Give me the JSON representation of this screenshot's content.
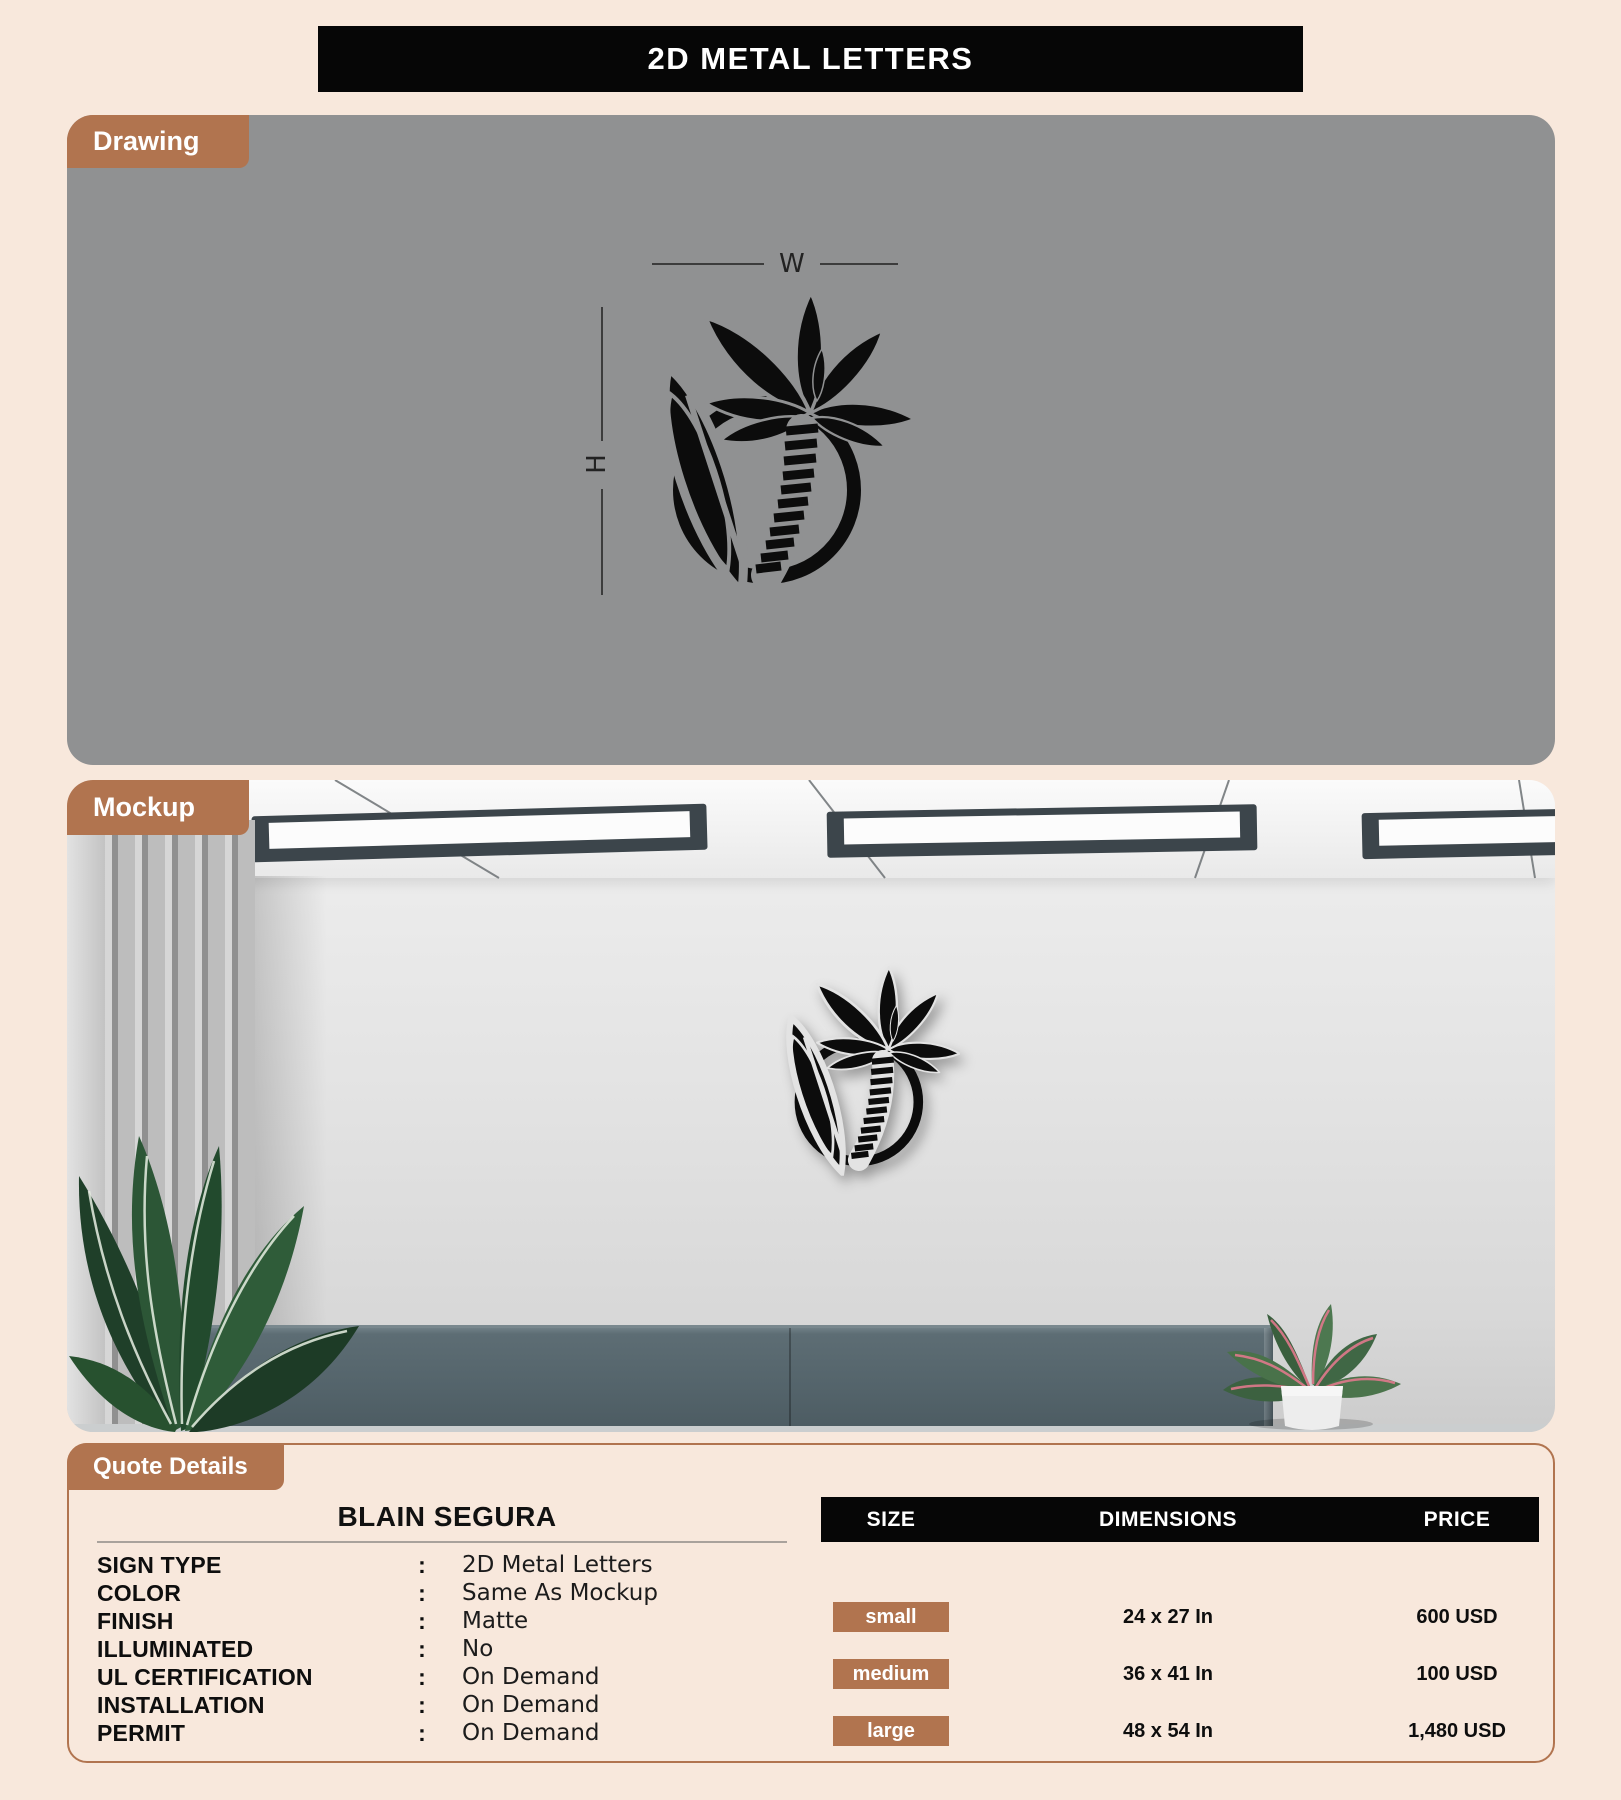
{
  "page": {
    "title": "2D METAL LETTERS"
  },
  "colors": {
    "accent": "#b1744f",
    "title_bar": "#060606",
    "drawing_panel": "#909192",
    "logo": "#0c0c0c",
    "background": "#f8e8dc",
    "cabinet": "#54646b"
  },
  "icons": {
    "logo": "palm-tree-surfboard-logo"
  },
  "sections": {
    "drawing": {
      "label": "Drawing",
      "width_label": "W",
      "height_label": "H"
    },
    "mockup": {
      "label": "Mockup"
    },
    "quote": {
      "label": "Quote Details",
      "customer": "BLAIN SEGURA",
      "colon": ":",
      "specs": [
        {
          "label": "SIGN TYPE",
          "value": "2D Metal Letters"
        },
        {
          "label": "COLOR",
          "value": "Same As Mockup"
        },
        {
          "label": "FINISH",
          "value": "Matte"
        },
        {
          "label": "ILLUMINATED",
          "value": "No"
        },
        {
          "label": "UL CERTIFICATION",
          "value": "On Demand"
        },
        {
          "label": "INSTALLATION",
          "value": "On Demand"
        },
        {
          "label": "PERMIT",
          "value": "On Demand"
        }
      ],
      "table": {
        "headers": [
          "SIZE",
          "DIMENSIONS",
          "PRICE"
        ],
        "rows": [
          {
            "size": "small",
            "dimensions": "24 x 27 In",
            "price": "600 USD"
          },
          {
            "size": "medium",
            "dimensions": "36 x 41 In",
            "price": "100 USD"
          },
          {
            "size": "large",
            "dimensions": "48 x 54 In",
            "price": "1,480 USD"
          }
        ]
      }
    }
  }
}
